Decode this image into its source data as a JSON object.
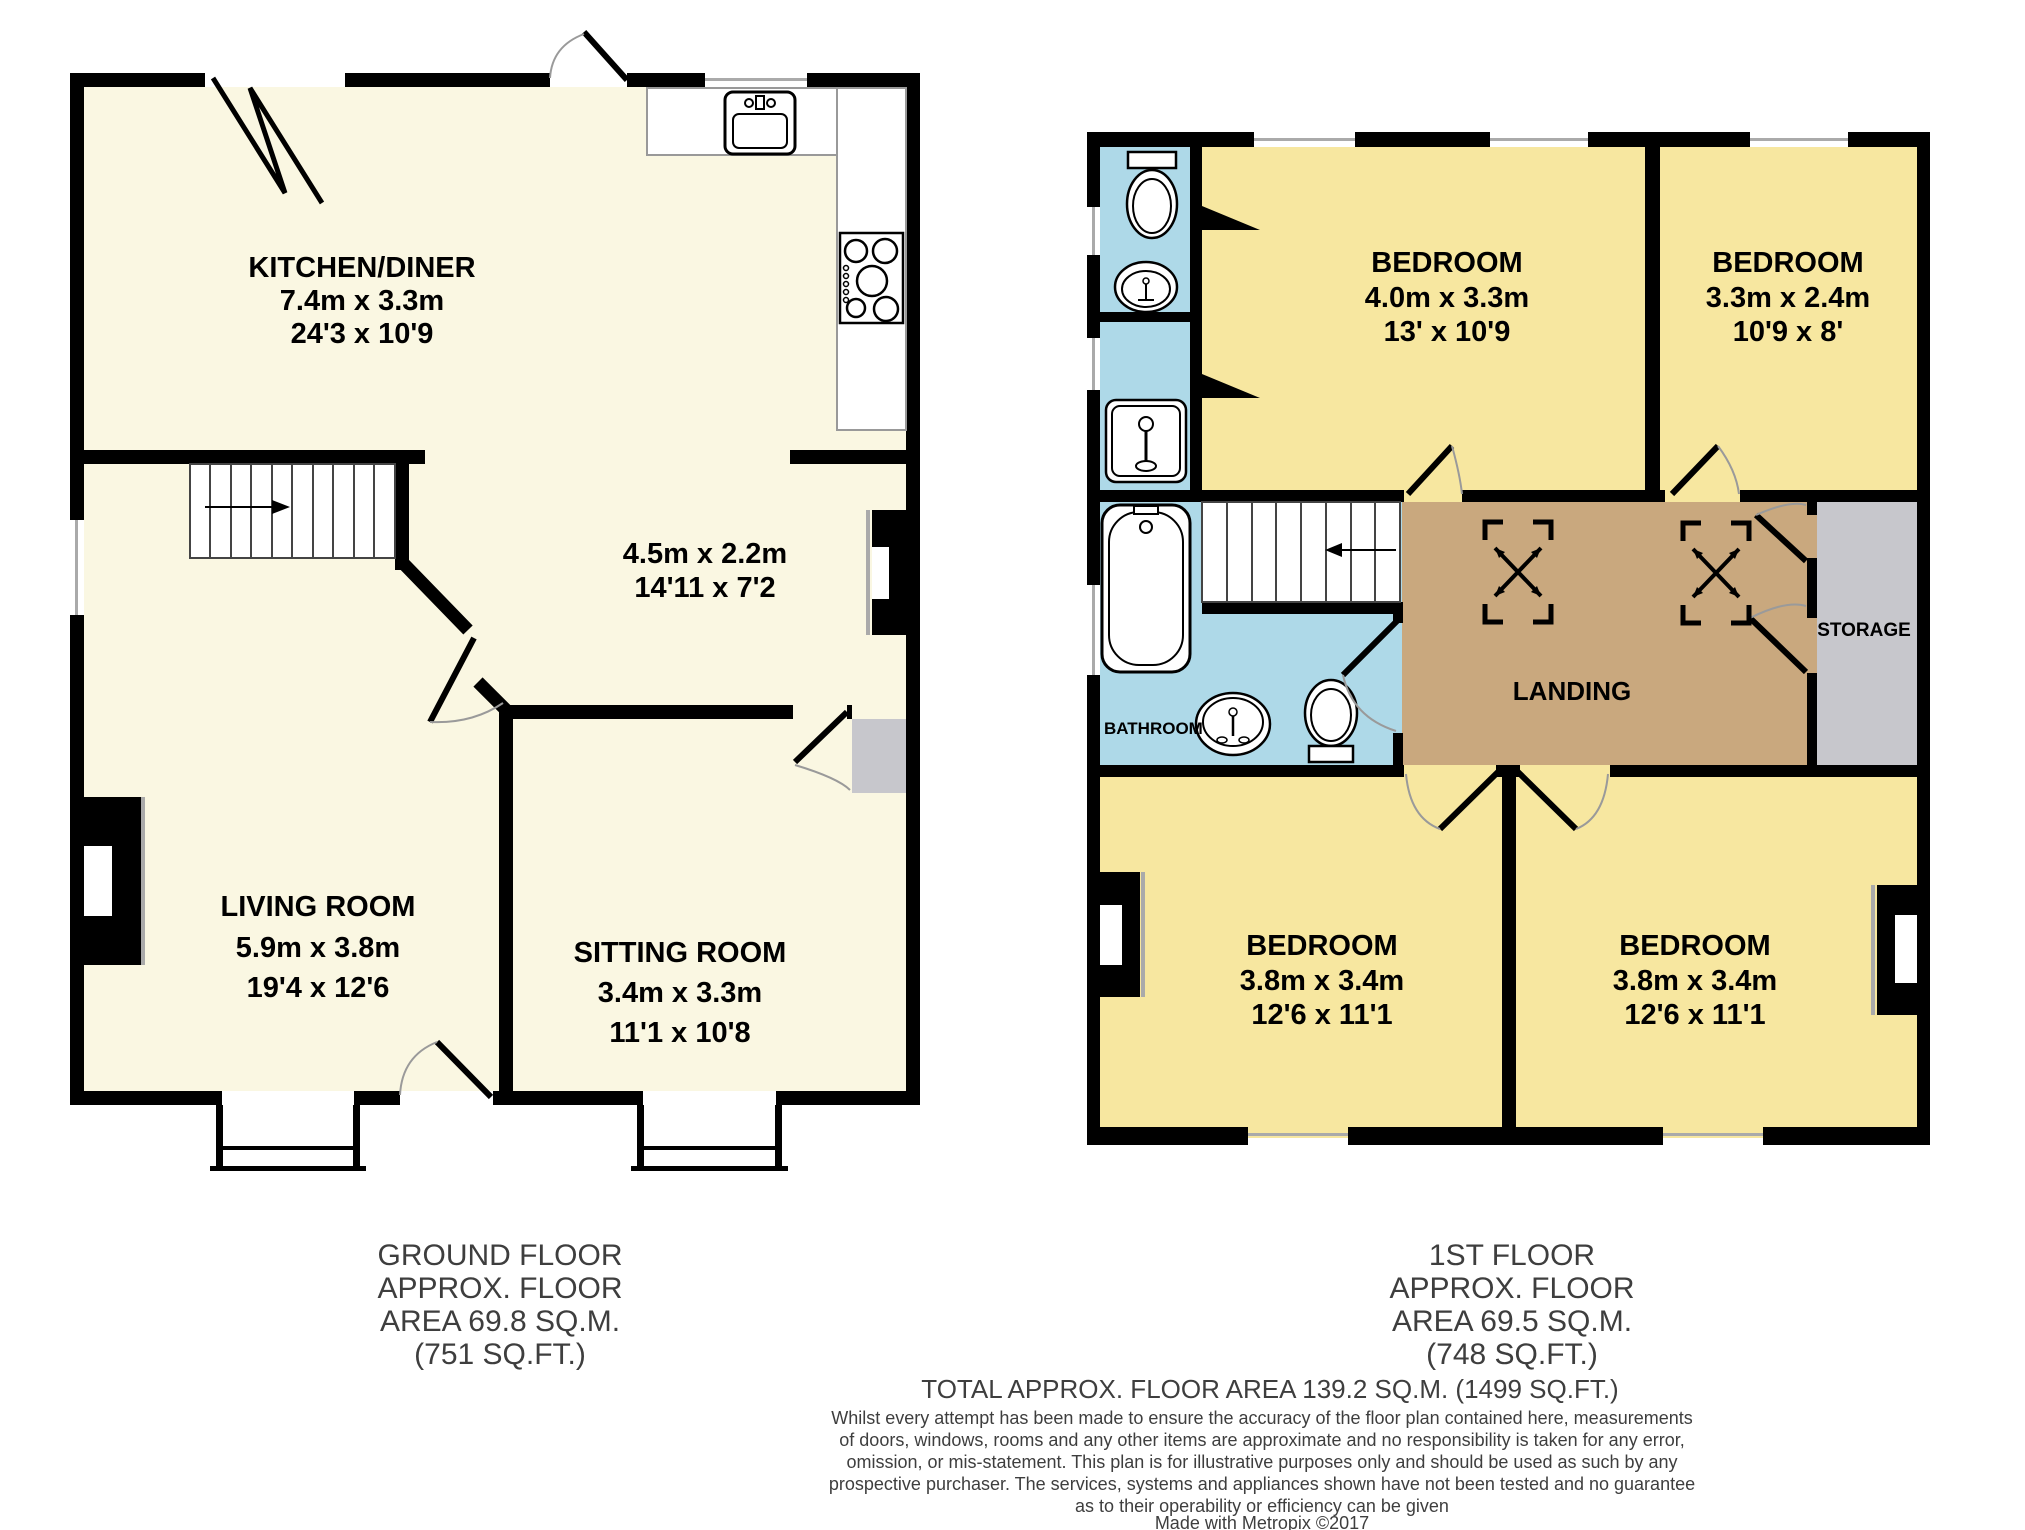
{
  "colors": {
    "wall": "#000000",
    "floor_cream": "#FAF7E2",
    "floor_yellow": "#F7E7A0",
    "floor_blue": "#AED9E8",
    "floor_tan": "#C9A87E",
    "floor_gray": "#C7C7CC",
    "footer_text": "#3E3E3E"
  },
  "ground_floor": {
    "kitchen": {
      "name": "KITCHEN/DINER",
      "metric": "7.4m x 3.3m",
      "imperial": "24'3 x 10'9"
    },
    "hallway": {
      "metric": "4.5m x 2.2m",
      "imperial": "14'11 x 7'2"
    },
    "living_room": {
      "name": "LIVING ROOM",
      "metric": "5.9m x 3.8m",
      "imperial": "19'4 x 12'6"
    },
    "sitting_room": {
      "name": "SITTING ROOM",
      "metric": "3.4m x 3.3m",
      "imperial": "11'1 x 10'8"
    },
    "footer_lines": [
      "GROUND FLOOR",
      "APPROX. FLOOR",
      "AREA 69.8 SQ.M.",
      "(751 SQ.FT.)"
    ]
  },
  "first_floor": {
    "bedroom_front_large": {
      "name": "BEDROOM",
      "metric": "4.0m x 3.3m",
      "imperial": "13' x 10'9"
    },
    "bedroom_front_small": {
      "name": "BEDROOM",
      "metric": "3.3m x 2.4m",
      "imperial": "10'9 x 8'"
    },
    "bedroom_back_left": {
      "name": "BEDROOM",
      "metric": "3.8m x 3.4m",
      "imperial": "12'6 x 11'1"
    },
    "bedroom_back_right": {
      "name": "BEDROOM",
      "metric": "3.8m x 3.4m",
      "imperial": "12'6 x 11'1"
    },
    "bathroom_label": "BATHROOM",
    "landing_label": "LANDING",
    "storage_label": "STORAGE",
    "footer_lines": [
      "1ST FLOOR",
      "APPROX. FLOOR",
      "AREA 69.5 SQ.M.",
      "(748 SQ.FT.)"
    ]
  },
  "summary": {
    "total_line": "TOTAL APPROX. FLOOR AREA 139.2 SQ.M. (1499 SQ.FT.)",
    "disclaimer_lines": [
      "Whilst every attempt has been made to ensure the accuracy of the floor plan contained here, measurements",
      "of doors, windows, rooms and any other items are approximate and no responsibility is taken for any error,",
      "omission, or mis-statement. This plan is for illustrative purposes only and should be used as such by any",
      "prospective purchaser. The services, systems and appliances shown have not been tested and no guarantee",
      "as to their operability or efficiency can be given"
    ],
    "credit_line": "Made with Metropix ©2017"
  }
}
